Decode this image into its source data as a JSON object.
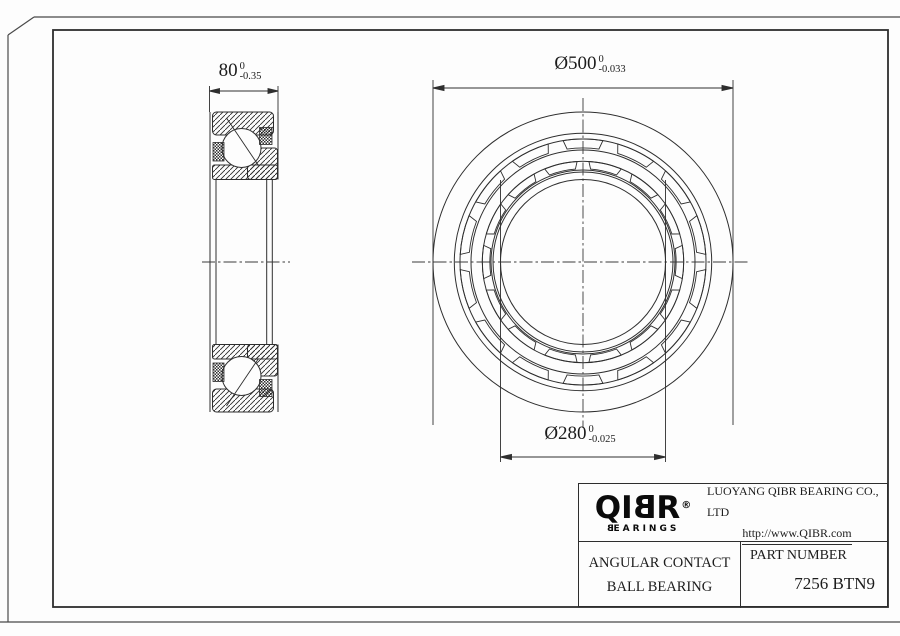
{
  "title_block": {
    "logo": {
      "q": "Q",
      "i": "I",
      "b": "B",
      "r": "R",
      "registered": "®",
      "bearings_first": "B",
      "bearings_rest": "EARINGS"
    },
    "company_name": "LUOYANG QIBR BEARING CO., LTD",
    "company_url": "http://www.QIBR.com",
    "product_line1": "ANGULAR CONTACT",
    "product_line2": "BALL BEARING",
    "part_number_label": "PART NUMBER",
    "part_number": "7256 BTN9"
  },
  "dimensions": {
    "width": {
      "value": "80",
      "tol_upper": "0",
      "tol_lower": "-0.35"
    },
    "outer_diameter": {
      "value": "Ø500",
      "tol_upper": "0",
      "tol_lower": "-0.033"
    },
    "bore": {
      "value": "Ø280",
      "tol_upper": "0",
      "tol_lower": "-0.025"
    }
  },
  "colors": {
    "line": "#2e2e2e",
    "background": "#fdfdfd"
  }
}
